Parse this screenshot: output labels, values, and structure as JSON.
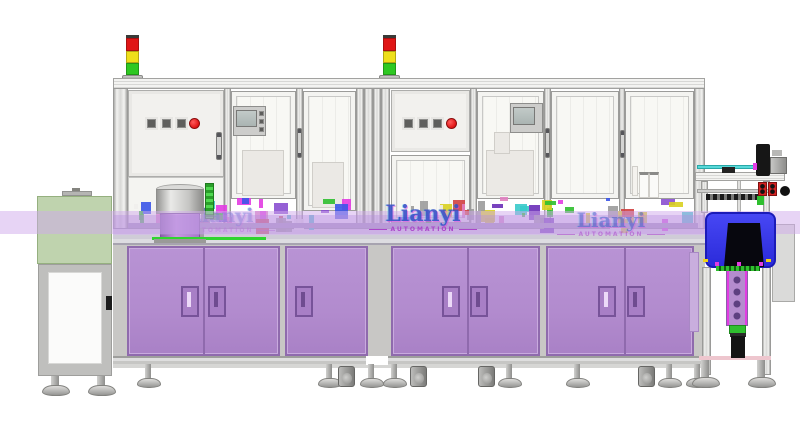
{
  "scene": {
    "kind": "cad-render-side-elevation",
    "subject": "automated assembly line with two enclosed stations, purple cabinet bases, end conveyor tunnel and end press station"
  },
  "watermark": {
    "brand": "Lianyi",
    "subtitle": "AUTOMATION",
    "instances": 3
  },
  "stack_lights": {
    "count": 2,
    "segments": [
      "red",
      "yellow",
      "green"
    ]
  },
  "control_panels": {
    "count": 2,
    "square_buttons_per_panel": 3,
    "emergency_stop_per_panel": 1
  },
  "colors": {
    "cabinet": "#b28bce",
    "cabinetDark": "#8f6aad",
    "band": "#cfa9ec",
    "greenBox": "#9abb80",
    "blueBox": "#3636ee",
    "blueBoxDark": "#1b1bb8",
    "stackRed": "#e01616",
    "stackYellow": "#efdf1a",
    "stackGreen": "#2ec822",
    "estop": "#e01414",
    "accentGreen": "#2fbf2f",
    "accentMagenta": "#e23ce2",
    "accentCyan": "#58d8d8",
    "actuator": "#b48cce",
    "wmBlue": "#3952c8",
    "wmViolet": "#a83cc8"
  },
  "deck_palette": [
    "#2fbf2f",
    "#e23ce2",
    "#8a4fd0",
    "#38caca",
    "#3b55e8",
    "#d8d020",
    "#d04040",
    "#9b9b9b",
    "#efeeec",
    "#6a2fb8",
    "#e080c0"
  ]
}
